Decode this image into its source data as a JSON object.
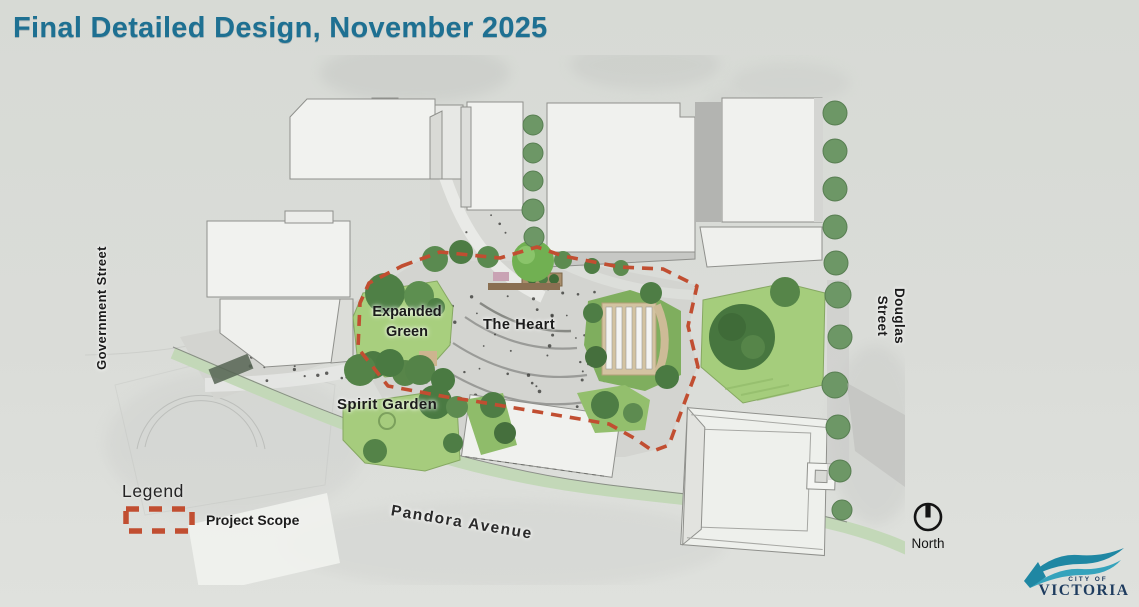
{
  "slide": {
    "title": "Final Detailed Design, November 2025"
  },
  "map": {
    "streets": {
      "government": "Government Street",
      "douglas": "Douglas Street",
      "pandora": "Pandora Avenue"
    },
    "areas": {
      "expanded_green": "Expanded Green",
      "heart": "The Heart",
      "spirit_garden": "Spirit Garden"
    }
  },
  "legend": {
    "heading": "Legend",
    "items": [
      {
        "label": "Project Scope",
        "swatch": "dashed-outline"
      }
    ]
  },
  "compass": {
    "label": "North"
  },
  "logo": {
    "line1": "CITY OF",
    "line2": "VICTORIA"
  },
  "colors": {
    "background": "#d9dcd8",
    "title": "#1e7092",
    "scope_dash": "#c14e31",
    "lawn": "#a8cf7e",
    "tree": "#4f8046",
    "logo_teal": "#1f87a3",
    "logo_teal_light": "#35a3bc",
    "logo_navy": "#1e3c5f",
    "label_text": "#1b1b1b"
  }
}
